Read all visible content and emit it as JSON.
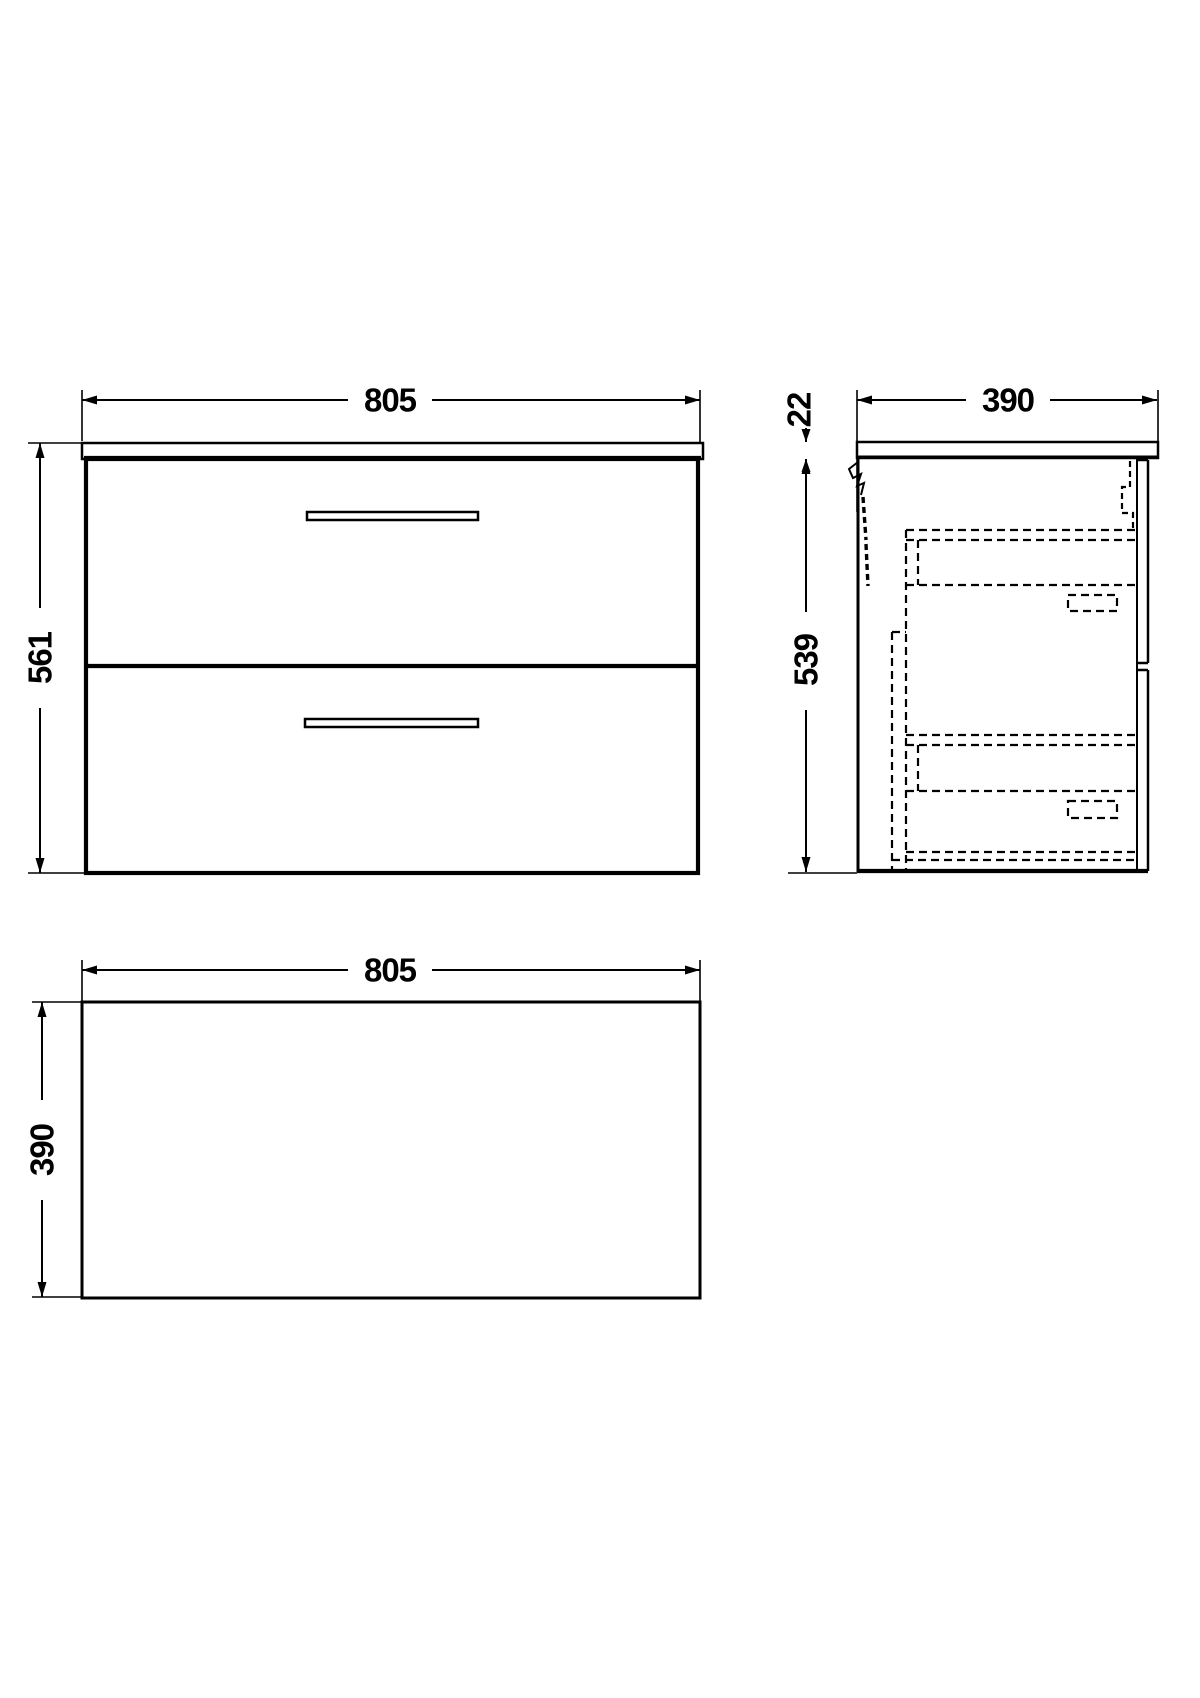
{
  "drawing": {
    "front_view": {
      "width_label": "805",
      "height_label": "561"
    },
    "side_view": {
      "depth_label": "390",
      "countertop_thickness_label": "22",
      "body_height_label": "539"
    },
    "plan_view": {
      "width_label": "805",
      "depth_label": "390"
    }
  }
}
